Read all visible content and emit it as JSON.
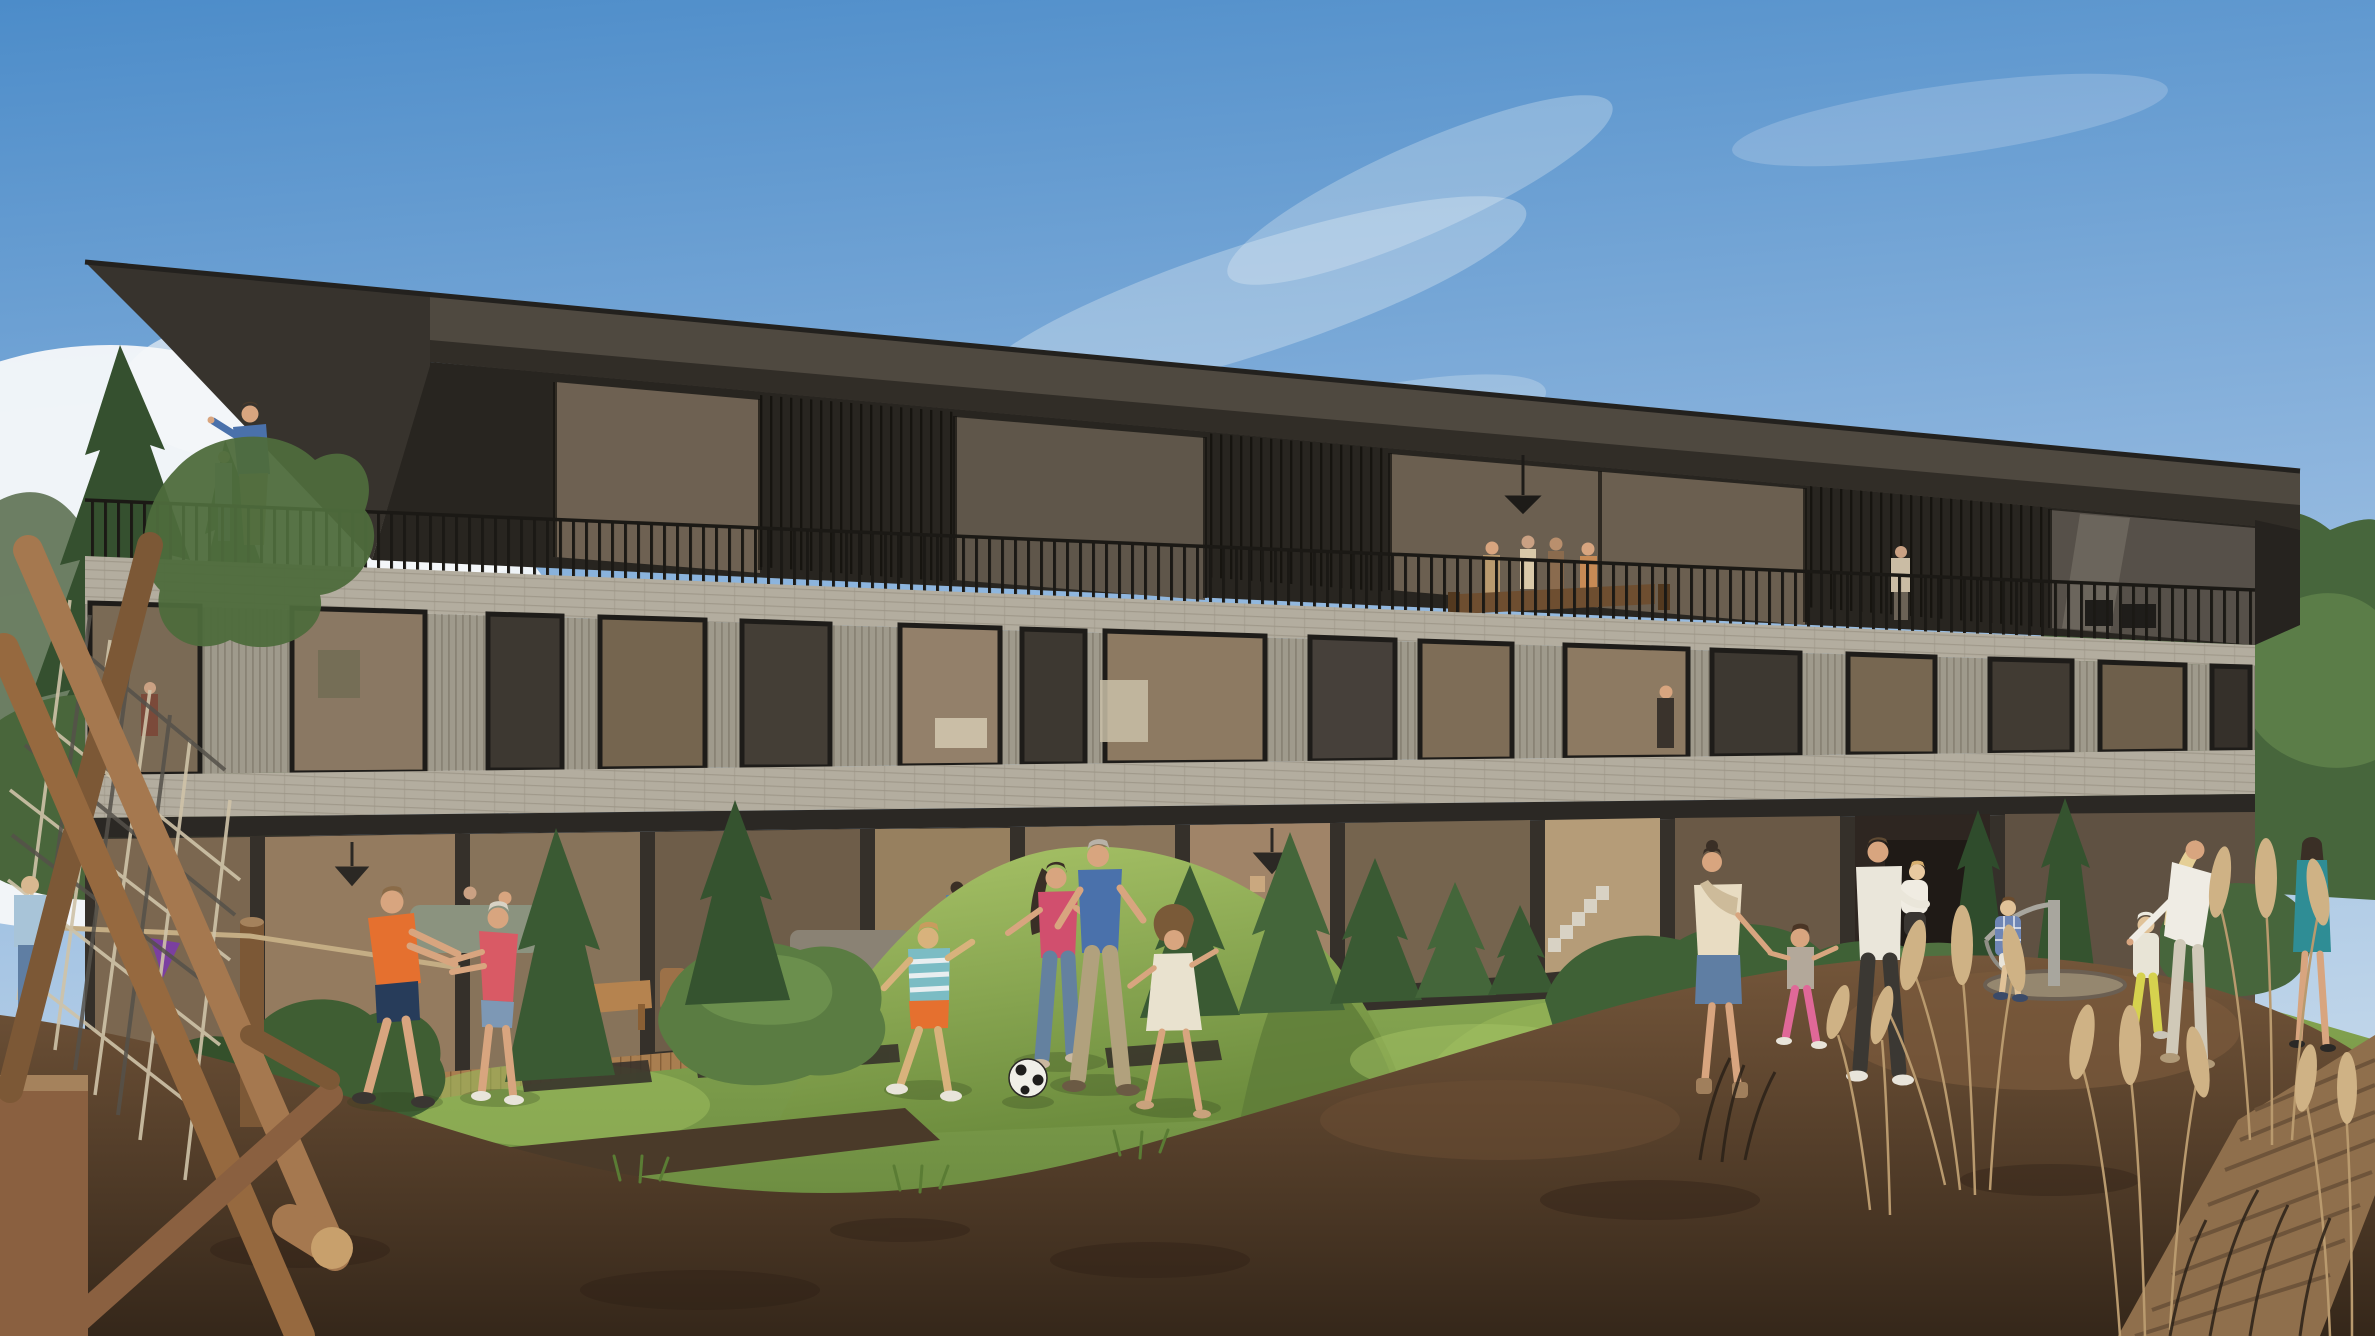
{
  "meta": {
    "type": "architectural-rendering",
    "description": "Photorealistic render of a modern three-storey apartment building with stone bands and dark glass, families playing on a lawn and natural-wood playground in the foreground, blue sky with cumulus clouds."
  },
  "scene": {
    "building": {
      "storeys": 3,
      "features": [
        "cantilevered dark roof",
        "rooftop terrace with bar railing",
        "limestone brick bands",
        "vertical slat stone piers",
        "full-height glazing",
        "ground-floor garden terraces"
      ]
    },
    "people_groups": [
      "man-and-child-on-roof-terrace",
      "dinner-party-on-balcony",
      "person-on-right-balcony",
      "kids-tug-of-war",
      "family-playing-football",
      "family-walking-on-mulch",
      "father-holding-baby",
      "toddlers-on-carousel",
      "woman-leaning-at-carousel",
      "woman-walking-on-boardwalk",
      "child-climbing-log-frame"
    ],
    "playground": [
      "log-climbing-frame-with-rope-nets",
      "tug-rope-with-pennant",
      "steel-carousel",
      "bark-mulch-surface"
    ],
    "vegetation": [
      "pine-trees-left",
      "tree-canopy-right",
      "clipped-bushes",
      "young-conifers",
      "pampas-grass",
      "lawn-with-mound"
    ]
  },
  "colors": {
    "sky_top": "#4c8cc9",
    "sky_mid": "#8fb6de",
    "sky_horizon": "#cadcec",
    "cloud": "#f5f7f9",
    "roof": "#4f4940",
    "roof_shadow": "#37332d",
    "roof_edge": "#23211e",
    "facade_dark": "#282520",
    "glass_warm": "#6e6152",
    "glass_lit": "#93806a",
    "glass_dark": "#3d3831",
    "window_frame": "#1e1c19",
    "stone_band": "#b3ad9f",
    "stone_pier": "#9f9a8c",
    "railing": "#1b1915",
    "tree_canopy": "#47663c",
    "pine": "#35502f",
    "bush": "#3f5e33",
    "conifer": "#3a5a33",
    "lawn": "#86a651",
    "lawn_shade": "#5e7e38",
    "mound_light": "#a9c468",
    "mulch": "#74563a",
    "mulch_dark": "#35271a",
    "wood_log": "#a5784f",
    "wood_log_dark": "#7c5836",
    "wood_deck": "#a97e50",
    "boardwalk": "#8f6f4c",
    "pampas": "#cfb285",
    "rope": "#c4ad84",
    "pennant": "#7b3fa0",
    "skin": "#d8a57f",
    "shirt_orange": "#e5702f",
    "shorts_navy": "#273c5a",
    "shirt_pink": "#d95a65",
    "top_pink": "#d14f6e",
    "denim": "#7d98b5",
    "jeans": "#64819f",
    "shirt_blue": "#4a71ab",
    "stripe_teal": "#7bbcc4",
    "khaki": "#b1a17d",
    "dress_white": "#e9e2cf",
    "cream_top": "#e8dcc2",
    "white_tee": "#eae6da",
    "dress_teal": "#2f8d95",
    "pants_yellow": "#d6d24e",
    "blonde_hair": "#e5cf96",
    "dark_hair": "#3a2f26",
    "ball": "#f0efe8",
    "steel": "#a8a69e"
  }
}
